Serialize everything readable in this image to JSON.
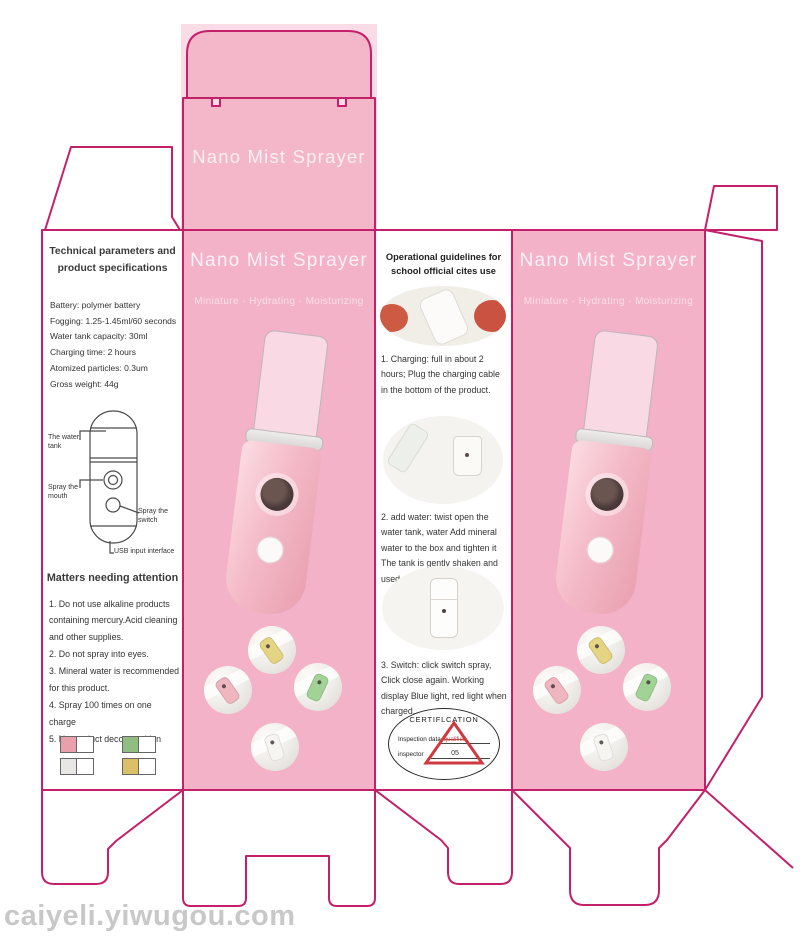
{
  "watermark": "caiyeli.yiwugou.com",
  "colors": {
    "dieline_magenta": "#c32069",
    "panel_pink": "#f3b2c7",
    "cert_red": "#cf3a40"
  },
  "top_flap": {
    "title": "Nano Mist Sprayer"
  },
  "left_panel": {
    "header": "Technical parameters and product specifications",
    "specs": [
      "Battery: polymer battery",
      "Fogging: 1.25-1.45ml/60 seconds",
      "Water tank capacity: 30ml",
      "Charging time: 2 hours",
      "Atomized particles: 0.3um",
      "Gross weight: 44g"
    ],
    "diagram_labels": {
      "tank": "The water tank",
      "mouth": "Spray the mouth",
      "switch": "Spray the switch",
      "usb": "USB input interface"
    },
    "attention_header": "Matters needing attention",
    "attention_items": [
      "1. Do not use alkaline products containing mercury.Acid cleaning and other supplies.",
      "2. Do not spray into eyes.",
      "3. Mineral water is recommended for this product.",
      "4. Spray 100 times on one charge",
      "5. No product decomposition"
    ],
    "swatches": [
      {
        "name": "pink",
        "hex": "#e9a0ab"
      },
      {
        "name": "green",
        "hex": "#8fbe80"
      },
      {
        "name": "gray",
        "hex": "#e9e7e4"
      },
      {
        "name": "yellow",
        "hex": "#dcc068"
      }
    ]
  },
  "front_panel": {
    "title": "Nano Mist Sprayer",
    "subtitle": "Miniature · Hydrating · Moisturizing",
    "stickers": [
      {
        "name": "yellow",
        "hex": "#e5d483"
      },
      {
        "name": "pink",
        "hex": "#f0b6bf"
      },
      {
        "name": "green",
        "hex": "#a2d295"
      },
      {
        "name": "white",
        "hex": "#f7f5f2"
      }
    ]
  },
  "guide_panel": {
    "header": "Operational guidelines for school official cites use",
    "steps": [
      "1. Charging: full in about 2 hours; Plug the charging cable in the bottom of the product.",
      "2. add water: twist open the water tank, water Add mineral water to the box and tighten it The tank is gently shaken and used.",
      "3. Switch: click switch spray, Click close again. Working display Blue light, red light when charged."
    ],
    "cert": {
      "title": "CERTIFLCATION",
      "line1": "Inspection data",
      "line2": "inspector",
      "stamp_word": "qualified",
      "stamp_num": "05"
    }
  },
  "side_panel": {
    "title": "Nano Mist Sprayer",
    "subtitle": "Miniature · Hydrating · Moisturizing"
  }
}
